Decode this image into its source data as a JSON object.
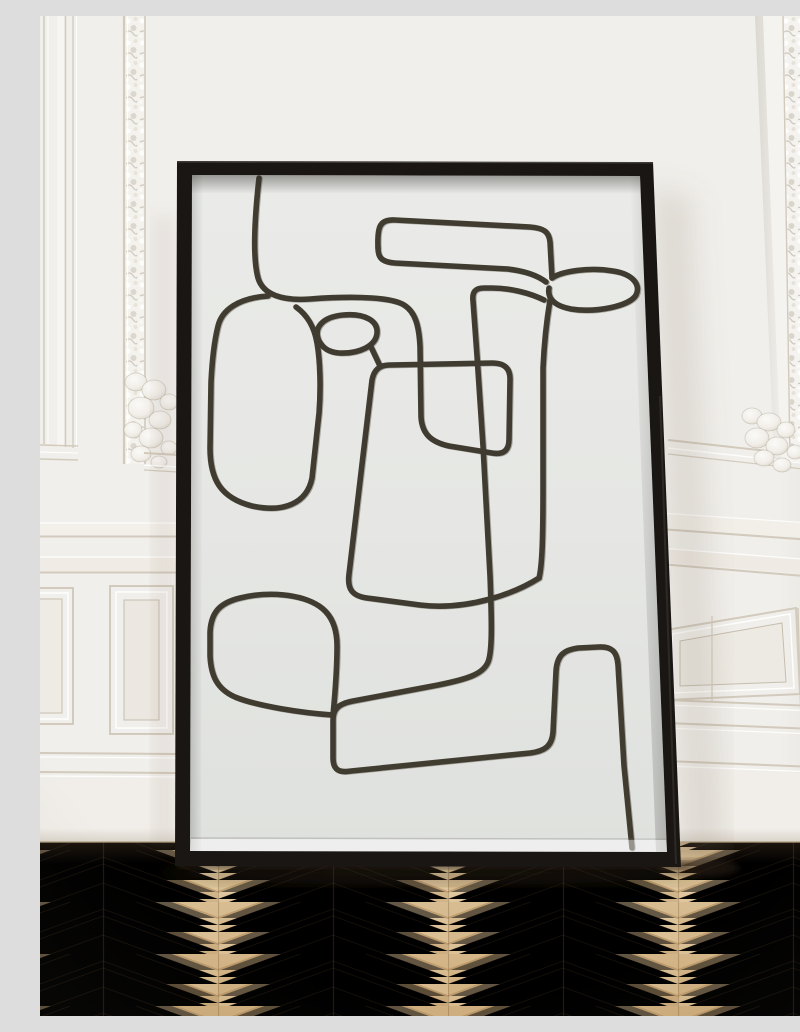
{
  "scene": {
    "type": "interior photograph (poster mockup)",
    "description": "A tall black-framed poster with an abstract one-line face drawing leans against a white classic-paneled wall, standing on a light oak herringbone parquet floor.",
    "artwork": {
      "style": "abstract continuous one-line drawing",
      "medium_look": "dark olive-brown crayon ink on off-white paper",
      "frame_material": "thin matte black wood frame",
      "orientation": "portrait",
      "placement": "leaning against wall on floor"
    },
    "wall": {
      "style": "white French wainscot paneling",
      "features": [
        "carved ornate trim strips",
        "acanthus corner ornaments",
        "chair rail",
        "beveled lower panels",
        "grooved baseboard"
      ]
    },
    "floor": {
      "style": "herringbone / chevron oak parquet",
      "tone": "light warm oak"
    }
  },
  "colors": {
    "wall": "#f1efeb",
    "wall-right": "#eae7e1",
    "molding-shadow": "#d2cabc",
    "molding-deep": "#c6bdae",
    "trim-white": "#f7f5f1",
    "frame": "#191613",
    "frame-edge": "#33302a",
    "paper": "#e6e7e4",
    "ink": "#3d382c",
    "ink-rust": "#6e5a38",
    "floor-light": "#e3cda6",
    "floor-mid": "#d5b88b",
    "floor-dark": "#c19e6c",
    "floor-seam": "#a8814f",
    "shadow": "#5f4f3b"
  }
}
